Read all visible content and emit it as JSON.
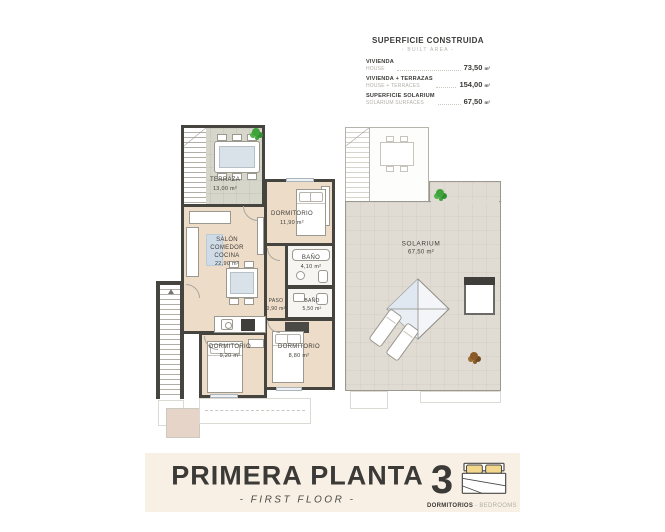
{
  "legend": {
    "title": "SUPERFICIE CONSTRUIDA",
    "subtitle": "- BUILT AREA -",
    "rows": [
      {
        "label_es": "VIVIENDA",
        "label_en": "HOUSE",
        "value": "73,50",
        "unit": "m²"
      },
      {
        "label_es": "VIVIENDA + TERRAZAS",
        "label_en": "HOUSE + TERRACES",
        "value": "154,00",
        "unit": "m²"
      },
      {
        "label_es": "SUPERFICIE SOLARIUM",
        "label_en": "SOLARIUM SURFACES",
        "value": "67,50",
        "unit": "m²"
      }
    ]
  },
  "plan": {
    "rooms": [
      {
        "name": "TERRAZA",
        "area": "13,00 m²"
      },
      {
        "name": "SALÓN\nCOMEDOR\nCOCINA",
        "area": "22,90 m²"
      },
      {
        "name": "DORMITORIO",
        "area": "11,90 m²"
      },
      {
        "name": "BAÑO",
        "area": "4,10 m²"
      },
      {
        "name": "PASO",
        "area": "0,90 m²"
      },
      {
        "name": "BAÑO",
        "area": "5,50 m²"
      },
      {
        "name": "DORMITORIO",
        "area": "9,20 m²"
      },
      {
        "name": "DORMITORIO",
        "area": "8,80 m²"
      },
      {
        "name": "SOLARIUM",
        "area": "67,50 m²"
      }
    ],
    "icons": [
      "tree-icon",
      "shrub-icon",
      "skylight-pyramid-icon",
      "sun-lounger-icon",
      "staircase-icon"
    ]
  },
  "footer": {
    "title": "PRIMERA PLANTA",
    "subtitle": "- FIRST FLOOR -",
    "bedrooms_count": "3",
    "bedrooms_label_es": "DORMITORIOS",
    "bedrooms_label_en": " - BEDROOMS",
    "bedrooms_icon": "double-bed-icon"
  },
  "colors": {
    "wall": "#45443f",
    "floor_interior": "#eddcc7",
    "floor_terrace": "#d6d6cb",
    "floor_solarium": "#e0dcd3",
    "pillow_accent": "#f2d78c",
    "plant_green": "#3fa33a",
    "plant_brown": "#8a5a28",
    "footer_background": "#f8f0e5",
    "text_dark": "#3b3a37",
    "text_muted": "#b2afa7",
    "skylight_blue": "#dfe7f0"
  }
}
